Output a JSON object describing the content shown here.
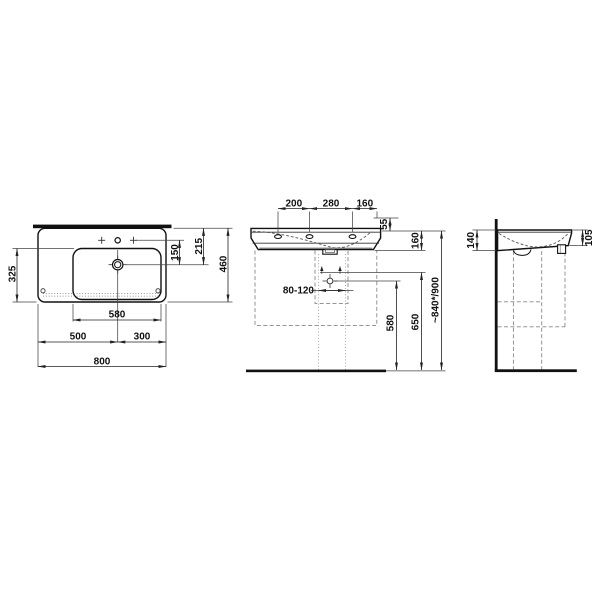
{
  "drawing_type": "washbasin-technical-dimension-drawing",
  "colors": {
    "line": "#111111",
    "background": "#ffffff"
  },
  "plan": {
    "width": "800",
    "width_left": "500",
    "width_right": "300",
    "bowl_width": "580",
    "depth": "460",
    "bowl_depth": "325",
    "tap_to_drain": "150",
    "rear_to_drain": "215"
  },
  "front": {
    "hole_pitch_left": "200",
    "hole_pitch_mid": "280",
    "hole_pitch_right": "160",
    "deck_to_rim": "55",
    "body_height": "160",
    "drain_range": "80-120",
    "floor_to_trap": "580",
    "floor_to_fixings": "650",
    "install_height": "~840*/900"
  },
  "side": {
    "height_rear": "140",
    "height_front": "105"
  }
}
